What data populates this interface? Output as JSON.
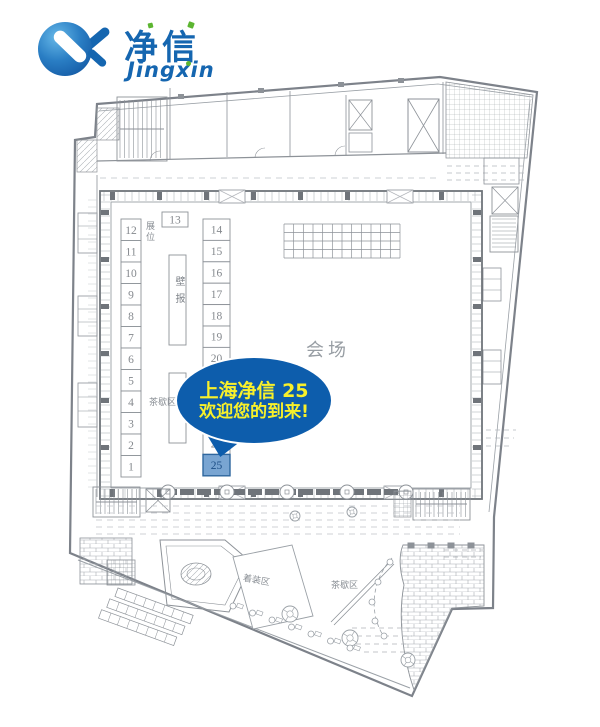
{
  "logo": {
    "brand_cn": "净信",
    "brand_en": "Jingxin"
  },
  "speech_bubble": {
    "line1": "上海净信 25",
    "line2": "欢迎您的到来!",
    "bg_color": "#0d5dac",
    "text_color": "#f8f02a"
  },
  "plan": {
    "hall_label": "会场",
    "booth_area_label": "展位",
    "poster_label": "壁报",
    "tea_break_inner_label": "茶歇区",
    "tea_break_outer_label": "茶歇区",
    "dressing_area_label": "着装区",
    "booths": {
      "left": [
        "12",
        "11",
        "10",
        "9",
        "8",
        "7",
        "6",
        "5",
        "4",
        "3",
        "2",
        "1"
      ],
      "top": "13",
      "right": [
        "14",
        "15",
        "16",
        "17",
        "18",
        "19",
        "20",
        "21",
        "22",
        "23",
        "24",
        "25"
      ],
      "highlight": "25"
    },
    "colors": {
      "line": "#8d9298",
      "line_light": "#b3b7bc",
      "line_dark": "#6f747a",
      "number_text": "#85898e",
      "highlight_fill": "#79a5d2",
      "highlight_border": "#2f679e",
      "highlight_text": "#1d4f87"
    }
  }
}
